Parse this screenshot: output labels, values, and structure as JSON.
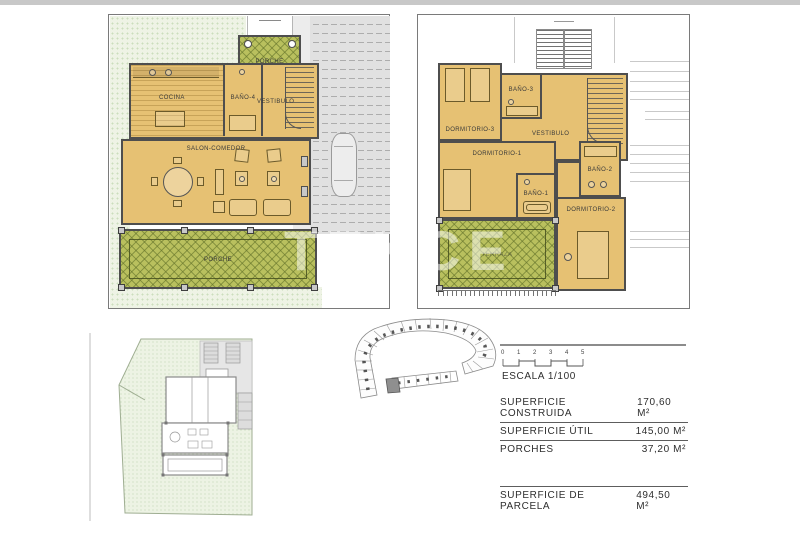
{
  "watermark": {
    "text": "TEKCE"
  },
  "ground_floor": {
    "porche_top": "PORCHE",
    "cocina": "COCINA",
    "bano4": "BAÑO-4",
    "vestibulo": "VESTIBULO",
    "salon_comedor": "SALON-COMEDOR",
    "porche_bottom": "PORCHE"
  },
  "first_floor": {
    "dormitorio3": "DORMITORIO-3",
    "bano3": "BAÑO-3",
    "vestibulo": "VESTIBULO",
    "dormitorio1": "DORMITORIO-1",
    "bano1": "BAÑO-1",
    "bano2": "BAÑO-2",
    "dormitorio2": "DORMITORIO-2",
    "terraza": "TERRAZA"
  },
  "scale_bar": {
    "ticks": [
      "0",
      "1",
      "2",
      "3",
      "4",
      "5"
    ],
    "label": "ESCALA 1/100"
  },
  "areas_table": {
    "rows": [
      {
        "label": "SUPERFICIE CONSTRUIDA",
        "value": "170,60 M²"
      },
      {
        "label": "SUPERFICIE ÚTIL",
        "value": "145,00 M²"
      },
      {
        "label": "PORCHES",
        "value": "37,20 M²"
      }
    ],
    "parcel_row": {
      "label": "SUPERFICIE DE PARCELA",
      "value": "494,50 M²"
    }
  },
  "colors": {
    "floor_tan": "#e6c173",
    "porch_green": "#b9c05e",
    "lawn_green": "#eef3e5",
    "wall_gray": "#4e4e4e"
  }
}
